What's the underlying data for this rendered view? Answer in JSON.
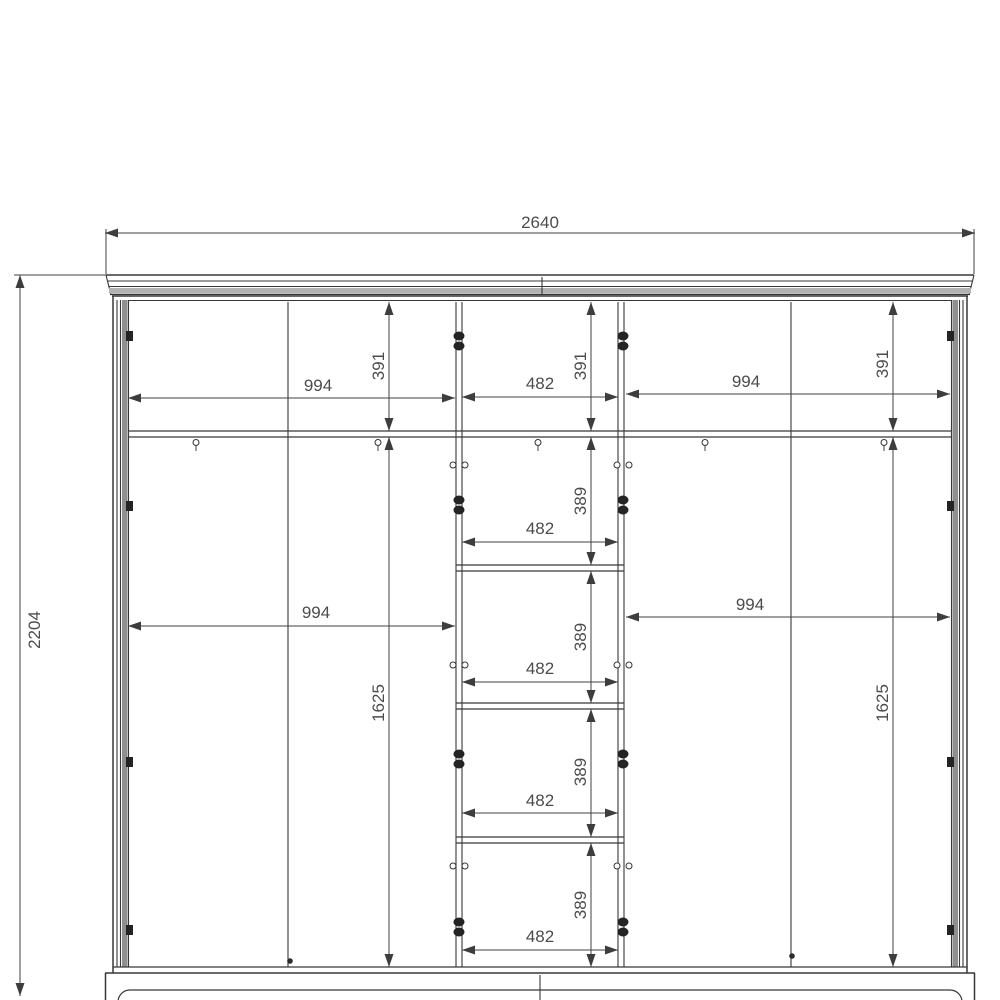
{
  "colors": {
    "background": "#ffffff",
    "line": "#3a3a3a",
    "panel_shade": "#8f8f8f",
    "cornice_shade": "#b2b2b2"
  },
  "dim_labels": {
    "overall_width": "2640",
    "overall_height": "2204",
    "side_section_width": "994",
    "center_section_width": "482",
    "top_compartment_height": "391",
    "center_compartment_height": "389",
    "door_section_height": "1625"
  }
}
